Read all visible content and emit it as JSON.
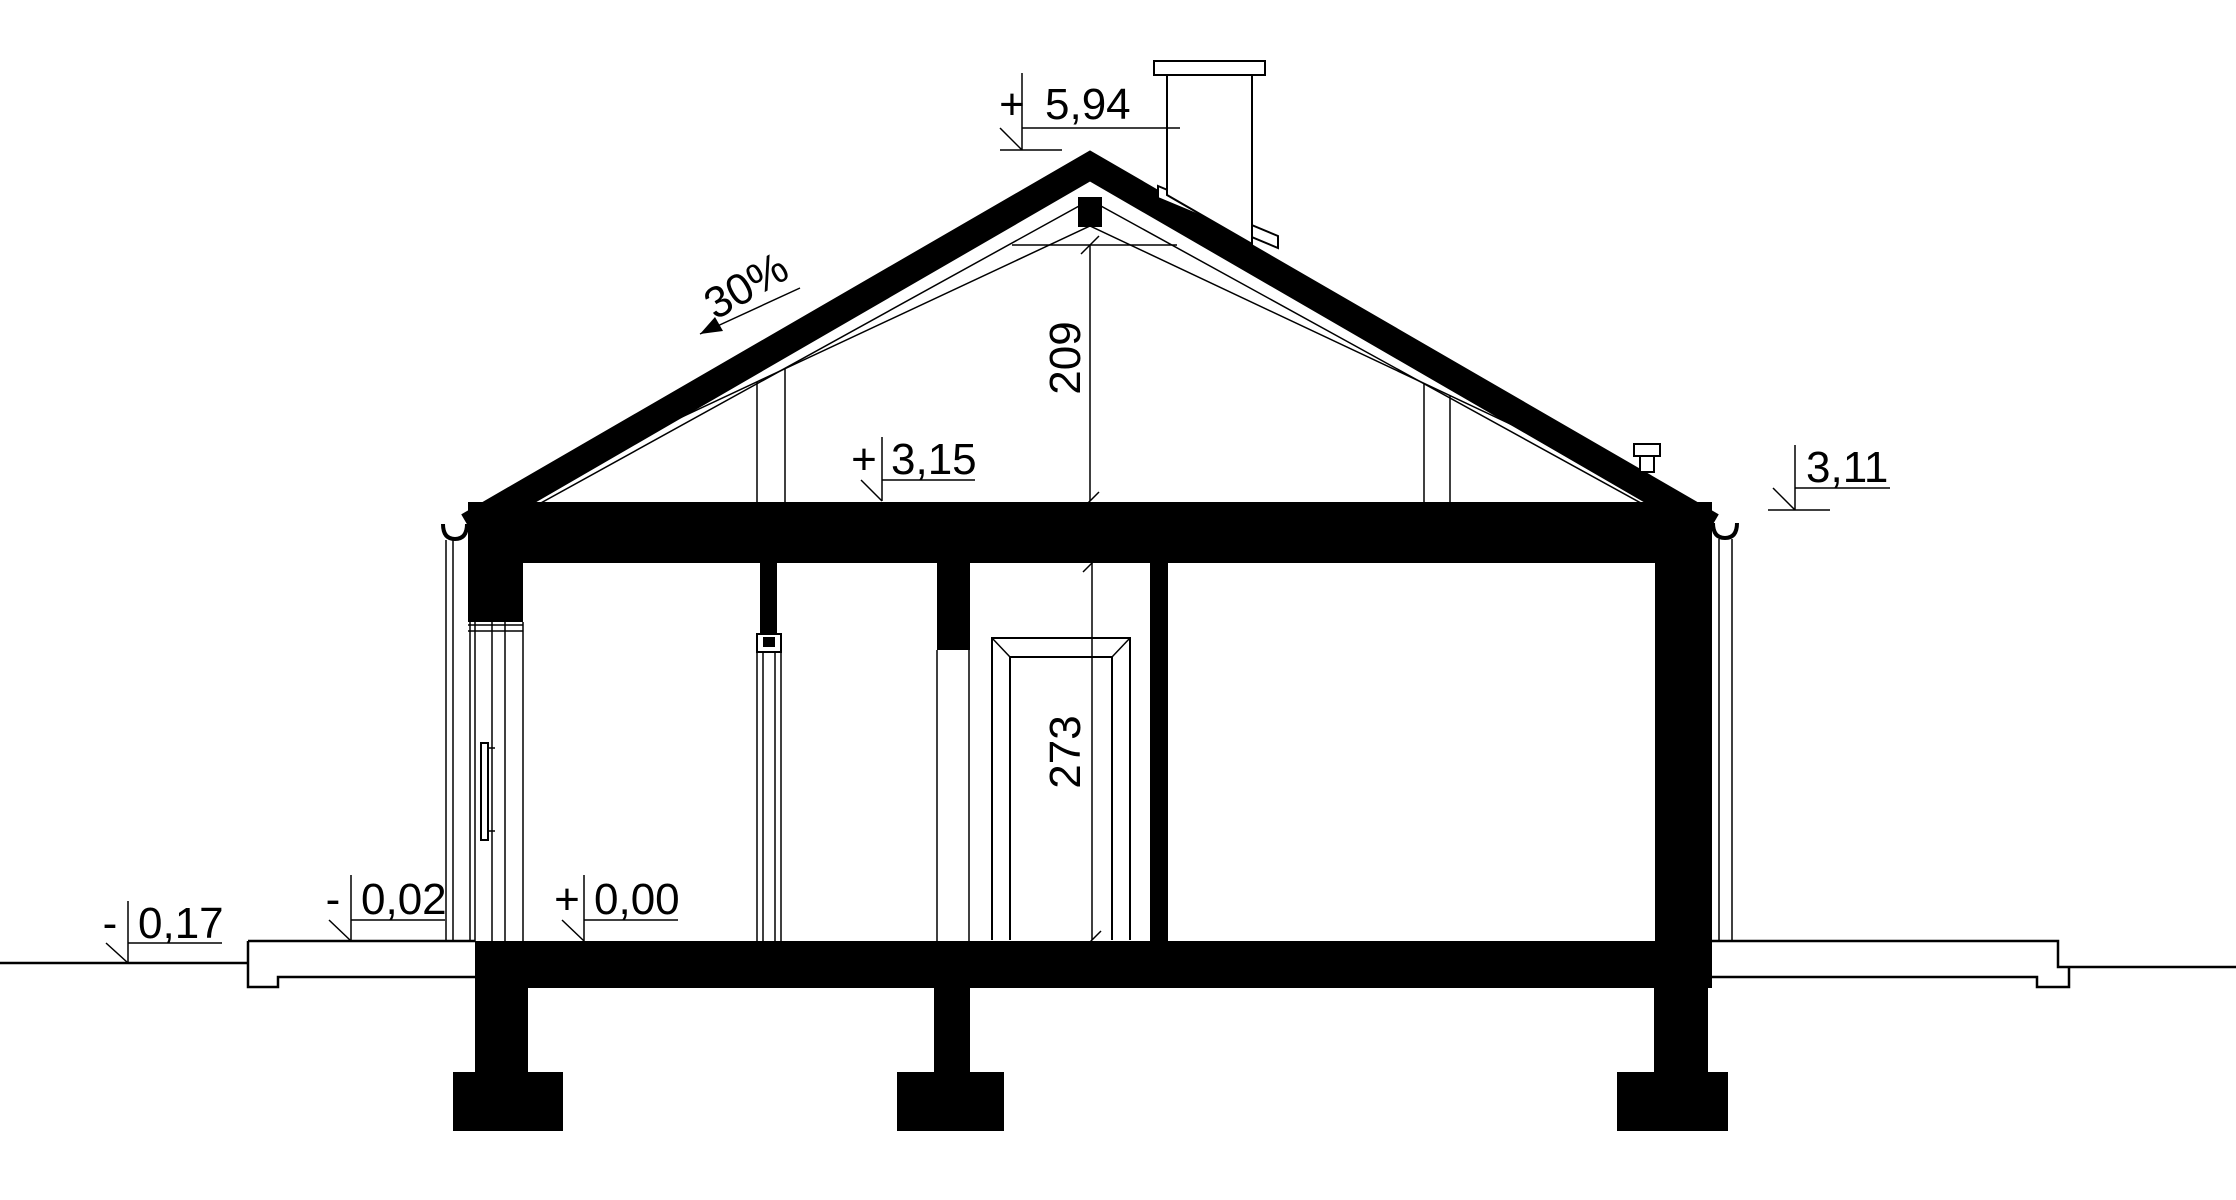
{
  "levels": {
    "ridge": {
      "sign": "+",
      "value": "5,94"
    },
    "ceiling": {
      "sign": "+",
      "value": "3,15"
    },
    "eaves": {
      "sign": "",
      "value": "3,11"
    },
    "ground": {
      "sign": "-",
      "value": "0,17"
    },
    "porch": {
      "sign": "-",
      "value": "0,02"
    },
    "floor": {
      "sign": "+",
      "value": "0,00"
    }
  },
  "dimensions": {
    "attic_height_cm": "209",
    "room_height_cm": "273"
  },
  "roof": {
    "slope": "30%"
  },
  "colors": {
    "ink": "#000000",
    "background": "#ffffff"
  }
}
